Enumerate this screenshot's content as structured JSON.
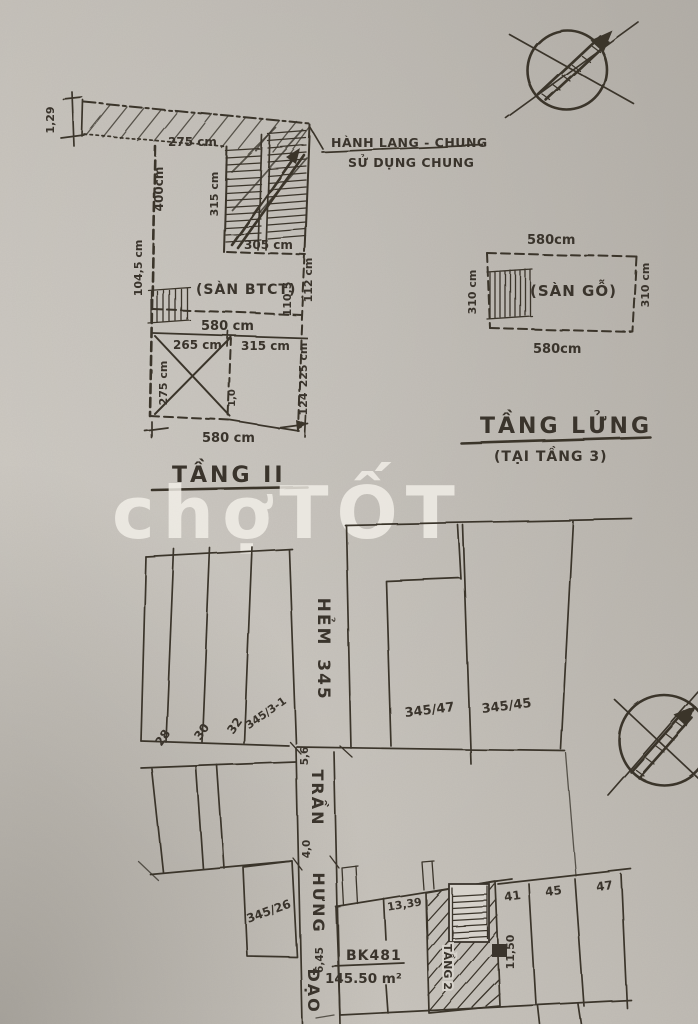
{
  "watermark": {
    "text_lower": "chợ",
    "text_upper": "TỐT"
  },
  "floor2_plan": {
    "title": "TẦNG II",
    "note_line1": "HÀNH LANG - CHUNG",
    "note_line2": "SỬ DỤNG CHUNG",
    "room_label": "(SÀN BTCT)",
    "dim_strip_width": "1,29",
    "dim_strip_left": "275 cm",
    "dim_stair_bottom": "305 cm",
    "dim_stair_side": "315 cm",
    "dim_left_upper": "400cm",
    "dim_left_lower": "104,5 cm",
    "dim_mid_width": "580 cm",
    "dim_right_a": "110,5",
    "dim_right_b": "112 cm",
    "dim_low_left": "265 cm",
    "dim_low_right": "315 cm",
    "dim_cross": "275 cm",
    "dim_right_mid": "225 cm",
    "dim_right_low": "124",
    "dim_tiny": "1,0",
    "dim_bottom": "580 cm"
  },
  "mezzanine_plan": {
    "title": "TẦNG LỬNG",
    "subtitle": "(TẠI TẦNG 3)",
    "room_label": "(SÀN GỖ)",
    "dim_top": "580cm",
    "dim_bottom": "580cm",
    "dim_left": "310 cm",
    "dim_right": "310 cm"
  },
  "site_plan": {
    "alley_word": "HẺM",
    "alley_number": "345",
    "street_word1": "TRẦN",
    "street_word2": "HƯNG",
    "street_word3": "ĐẠO",
    "parcel_28": "28",
    "parcel_30": "30",
    "parcel_32": "32",
    "parcel_345_3_1": "345/3-1",
    "parcel_345_47": "345/47",
    "parcel_345_45": "345/45",
    "parcel_345_26": "345/26",
    "parcel_41": "41",
    "parcel_45": "45",
    "parcel_47": "47",
    "dim_alley_upper": "5,6",
    "dim_alley_lower": "4,0",
    "plot": {
      "id": "BK481",
      "area": "145.50 m²",
      "floor_note": "TẦNG 2",
      "dim_top": "13,39",
      "dim_right": "11,50",
      "dim_front": "6,45"
    }
  }
}
